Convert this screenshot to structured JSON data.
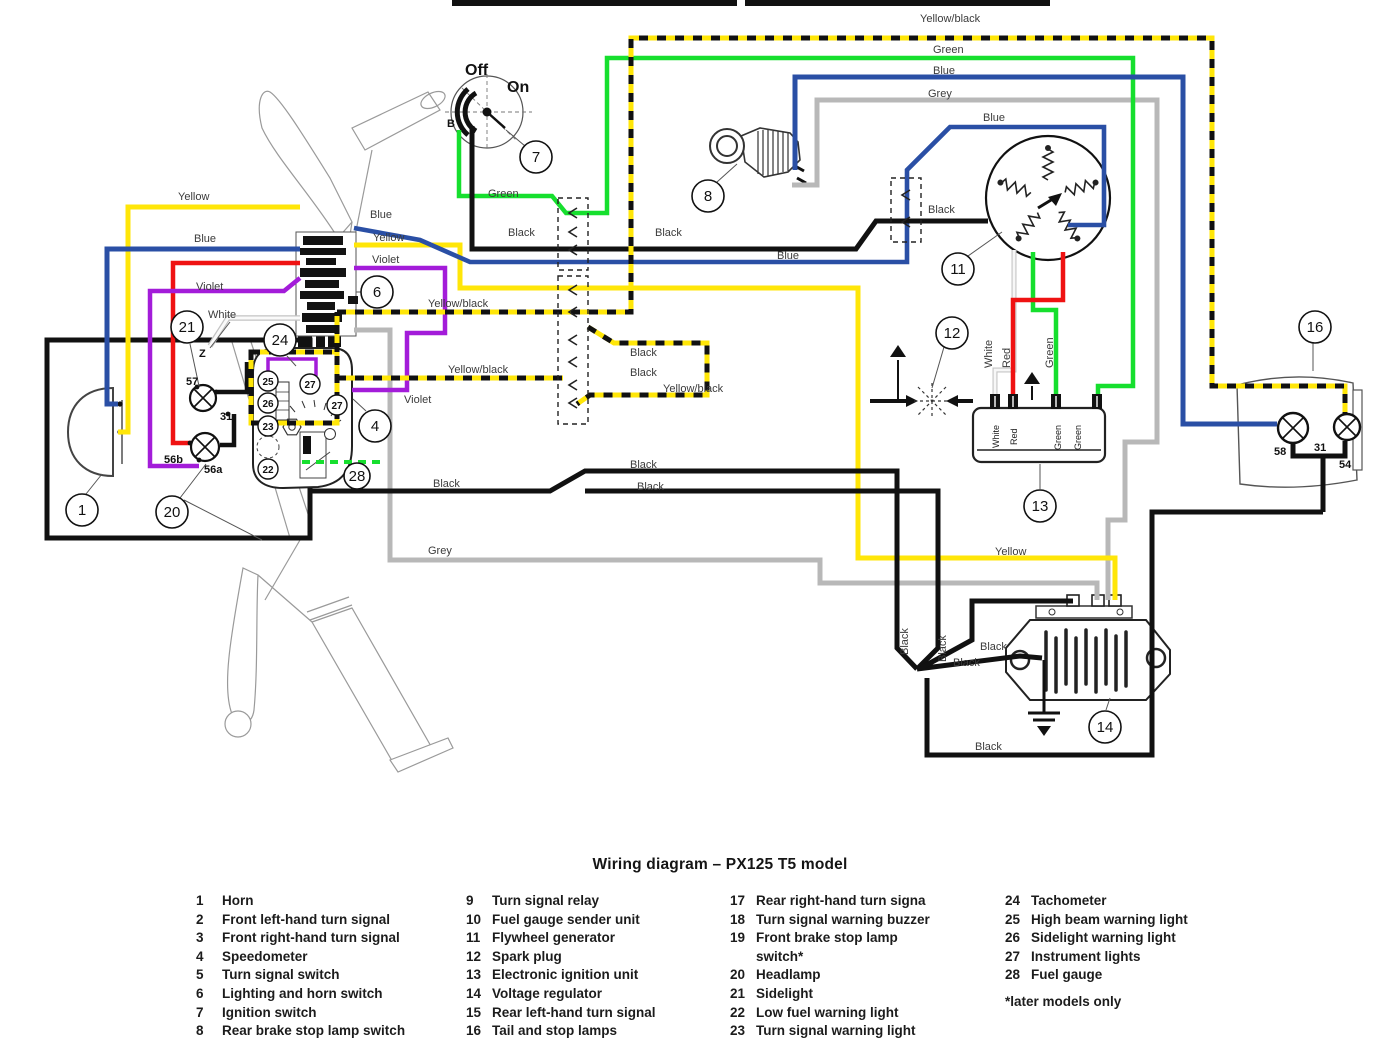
{
  "title": "Wiring diagram – PX125 T5 model",
  "w": {
    "yellow": "Yellow",
    "blue": "Blue",
    "green": "Green",
    "grey": "Grey",
    "black": "Black",
    "violet": "Violet",
    "white": "White",
    "red": "Red",
    "yellow_black": "Yellow/black"
  },
  "switch7": {
    "off": "Off",
    "on": "On",
    "b": "B"
  },
  "terminals": {
    "t57": "57",
    "t31": "31",
    "t56b": "56b",
    "t56a": "56a",
    "t58": "58",
    "t54": "54",
    "z": "Z"
  },
  "callouts": {
    "c1": "1",
    "c4": "4",
    "c6": "6",
    "c7": "7",
    "c8": "8",
    "c11": "11",
    "c12": "12",
    "c13": "13",
    "c14": "14",
    "c16": "16",
    "c20": "20",
    "c21": "21",
    "c22": "22",
    "c23": "23",
    "c24": "24",
    "c25": "25",
    "c26": "26",
    "c27": "27",
    "c28": "28"
  },
  "colors": {
    "yellow": "#ffe608",
    "blue": "#2a4fa5",
    "green": "#16df2e",
    "grey": "#b8b8b8",
    "red": "#ef1212",
    "violet": "#a31cd9",
    "black": "#111111",
    "white_wire": "#f4f4f4"
  },
  "legend": {
    "col1": [
      {
        "n": "1",
        "t": "Horn"
      },
      {
        "n": "2",
        "t": "Front left-hand turn signal"
      },
      {
        "n": "3",
        "t": "Front right-hand turn signal"
      },
      {
        "n": "4",
        "t": "Speedometer"
      },
      {
        "n": "5",
        "t": "Turn signal switch"
      },
      {
        "n": "6",
        "t": "Lighting and horn switch"
      },
      {
        "n": "7",
        "t": "Ignition switch"
      },
      {
        "n": "8",
        "t": "Rear brake stop lamp switch"
      }
    ],
    "col2": [
      {
        "n": "9",
        "t": "Turn signal relay"
      },
      {
        "n": "10",
        "t": "Fuel gauge sender unit"
      },
      {
        "n": "11",
        "t": "Flywheel generator"
      },
      {
        "n": "12",
        "t": "Spark plug"
      },
      {
        "n": "13",
        "t": "Electronic ignition unit"
      },
      {
        "n": "14",
        "t": "Voltage regulator"
      },
      {
        "n": "15",
        "t": "Rear left-hand turn signal"
      },
      {
        "n": "16",
        "t": "Tail and stop lamps"
      }
    ],
    "col3": [
      {
        "n": "17",
        "t": "Rear right-hand turn signa"
      },
      {
        "n": "18",
        "t": "Turn signal warning buzzer"
      },
      {
        "n": "19",
        "t": "Front brake stop lamp"
      },
      {
        "n": "",
        "t": "switch*"
      },
      {
        "n": "20",
        "t": "Headlamp"
      },
      {
        "n": "21",
        "t": "Sidelight"
      },
      {
        "n": "22",
        "t": "Low fuel warning light"
      },
      {
        "n": "23",
        "t": "Turn signal warning light"
      }
    ],
    "col4": [
      {
        "n": "24",
        "t": "Tachometer"
      },
      {
        "n": "25",
        "t": "High beam warning light"
      },
      {
        "n": "26",
        "t": "Sidelight warning light"
      },
      {
        "n": "27",
        "t": "Instrument lights"
      },
      {
        "n": "28",
        "t": "Fuel gauge"
      }
    ],
    "footnote": "*later models only"
  }
}
